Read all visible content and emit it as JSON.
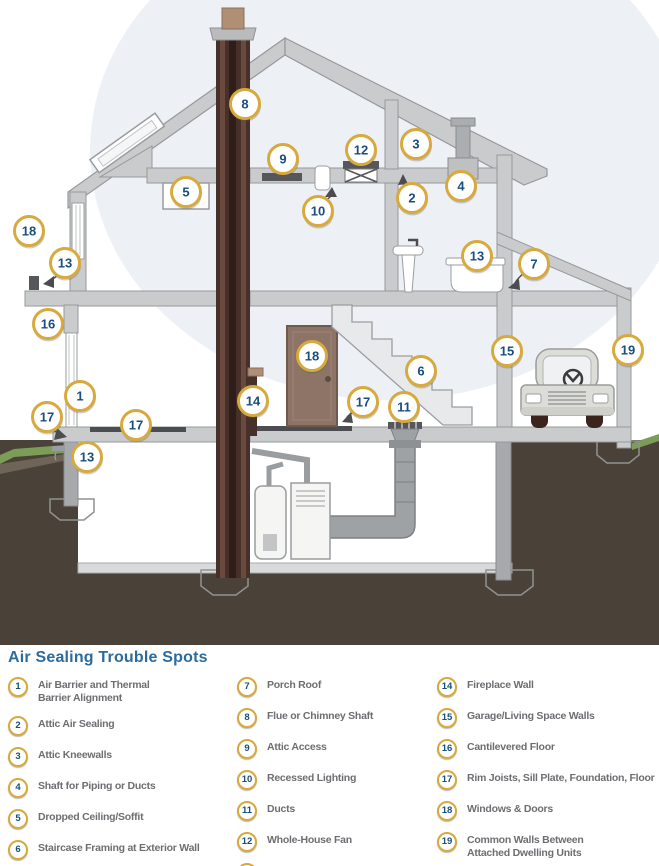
{
  "legend": {
    "title": "Air Sealing Trouble Spots",
    "columns": [
      [
        {
          "number": "1",
          "label": "Air Barrier and Thermal\nBarrier Alignment"
        },
        {
          "number": "2",
          "label": "Attic Air Sealing"
        },
        {
          "number": "3",
          "label": "Attic Kneewalls"
        },
        {
          "number": "4",
          "label": "Shaft for Piping or Ducts"
        },
        {
          "number": "5",
          "label": "Dropped Ceiling/Soffit"
        },
        {
          "number": "6",
          "label": "Staircase Framing at Exterior Wall"
        }
      ],
      [
        {
          "number": "7",
          "label": "Porch Roof"
        },
        {
          "number": "8",
          "label": "Flue or Chimney Shaft"
        },
        {
          "number": "9",
          "label": "Attic Access"
        },
        {
          "number": "10",
          "label": "Recessed Lighting"
        },
        {
          "number": "11",
          "label": "Ducts"
        },
        {
          "number": "12",
          "label": "Whole-House Fan"
        },
        {
          "number": "13",
          "label": "Exterior Wall Penetrations"
        }
      ],
      [
        {
          "number": "14",
          "label": "Fireplace Wall"
        },
        {
          "number": "15",
          "label": "Garage/Living Space Walls"
        },
        {
          "number": "16",
          "label": "Cantilevered Floor"
        },
        {
          "number": "17",
          "label": "Rim Joists, Sill Plate, Foundation, Floor"
        },
        {
          "number": "18",
          "label": "Windows & Doors"
        },
        {
          "number": "19",
          "label": "Common Walls Between\nAttached Dwelling Units"
        }
      ]
    ]
  },
  "diagram": {
    "markers": [
      {
        "n": "8",
        "x": 245,
        "y": 104
      },
      {
        "n": "9",
        "x": 283,
        "y": 159
      },
      {
        "n": "12",
        "x": 361,
        "y": 150
      },
      {
        "n": "3",
        "x": 416,
        "y": 144
      },
      {
        "n": "2",
        "x": 412,
        "y": 198
      },
      {
        "n": "4",
        "x": 461,
        "y": 186
      },
      {
        "n": "5",
        "x": 186,
        "y": 192
      },
      {
        "n": "10",
        "x": 318,
        "y": 211
      },
      {
        "n": "18",
        "x": 29,
        "y": 231
      },
      {
        "n": "13",
        "x": 65,
        "y": 263
      },
      {
        "n": "13",
        "x": 477,
        "y": 256
      },
      {
        "n": "7",
        "x": 534,
        "y": 264
      },
      {
        "n": "16",
        "x": 48,
        "y": 324
      },
      {
        "n": "15",
        "x": 507,
        "y": 351
      },
      {
        "n": "19",
        "x": 628,
        "y": 350
      },
      {
        "n": "18",
        "x": 312,
        "y": 356
      },
      {
        "n": "6",
        "x": 421,
        "y": 371
      },
      {
        "n": "1",
        "x": 80,
        "y": 396
      },
      {
        "n": "14",
        "x": 253,
        "y": 401
      },
      {
        "n": "17",
        "x": 47,
        "y": 417
      },
      {
        "n": "17",
        "x": 136,
        "y": 425
      },
      {
        "n": "17",
        "x": 363,
        "y": 402
      },
      {
        "n": "11",
        "x": 404,
        "y": 407
      },
      {
        "n": "13",
        "x": 87,
        "y": 457
      }
    ],
    "colors": {
      "marker_ring": "#D8A93C",
      "marker_number": "#1A4E7C",
      "title_blue": "#2C6B9E",
      "legend_text": "#6D6E71",
      "structure_gray": "#C9CBCD",
      "structure_outline": "#96989A",
      "chimney_brown": "#46302A",
      "soil_brown": "#4A4139",
      "grass_green": "#7C9D58",
      "door_brown": "#8D7466",
      "sky_tint": "#EDF1F6"
    }
  }
}
